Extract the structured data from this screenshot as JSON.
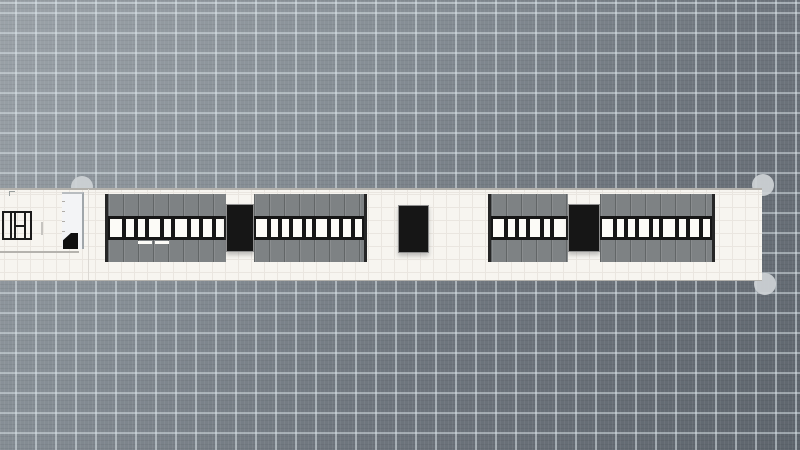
{
  "app": {
    "type": "floor-plan-editor",
    "view": "2d-top-plan",
    "visible_text": ""
  },
  "canvas": {
    "width": 800,
    "height": 450,
    "grid_major_size": 20,
    "grid_minor_size": 4
  },
  "colors": {
    "bg_light": "#9ca3a9",
    "bg_mid1": "#868e95",
    "bg_mid2": "#6f767e",
    "bg_dark": "#5e656d",
    "grid_major": "rgba(222,231,236,0.5)",
    "strip_fill": "#f7f5f0",
    "strip_grid": "#eae6e0",
    "strip_edge": "#b2b0ab",
    "shelf_gray": "#7e8284",
    "shelf_edge": "#262626",
    "window_black": "#161616",
    "cell_white": "#fcfbf7",
    "unit_black": "#161616",
    "unit_border": "#8f8f8f",
    "handle": "#ced3d6",
    "fixture_line": "#1b1b1b",
    "light_line": "#b5b3ae"
  },
  "floor_strip": {
    "x": 0,
    "y": 188,
    "width": 762,
    "height": 93,
    "grid_size": 13
  },
  "selection_handles": [
    {
      "id": "top-left",
      "cx": 82,
      "cy": 187,
      "r": 11
    },
    {
      "id": "top-right",
      "cx": 763,
      "cy": 185,
      "r": 11
    },
    {
      "id": "bottom-right",
      "cx": 765,
      "cy": 284,
      "r": 11
    }
  ],
  "shelf_runs": [
    {
      "id": "run-left",
      "x": 105,
      "y": 194,
      "height": 68,
      "segments": [
        {
          "kind": "bay",
          "width": 118,
          "cells": 9
        },
        {
          "kind": "end-cap",
          "width": 28
        },
        {
          "kind": "bay",
          "width": 110,
          "cells": 9
        }
      ]
    },
    {
      "id": "run-right",
      "x": 488,
      "y": 194,
      "height": 68,
      "segments": [
        {
          "kind": "bay",
          "width": 77,
          "cells": 6
        },
        {
          "kind": "end-cap",
          "width": 32
        },
        {
          "kind": "bay",
          "width": 112,
          "cells": 9
        }
      ]
    }
  ],
  "black_units": [
    {
      "id": "freestanding-end-unit",
      "x": 398,
      "y": 205,
      "width": 31,
      "height": 48
    }
  ],
  "cell_pattern": [
    1.5,
    1,
    1,
    1.3,
    0.9,
    1.6,
    1,
    1.2,
    1,
    1.1
  ],
  "price_tabs": [
    {
      "x": 138,
      "y": 241,
      "width": 14,
      "height": 3
    },
    {
      "x": 155,
      "y": 241,
      "width": 14,
      "height": 3
    }
  ],
  "left_fixtures": {
    "plan_symbol": {
      "x": 2,
      "y": 211,
      "width": 30,
      "height": 29
    },
    "corner_tick": {
      "x": 9,
      "y": 191,
      "width": 5,
      "height": 4
    },
    "door_tick": {
      "x": 41,
      "y": 222,
      "width": 2,
      "height": 13
    },
    "cabinet": {
      "x": 62,
      "y": 192,
      "width": 22,
      "height": 57,
      "ticks": 4
    },
    "wedge": {
      "x": 63,
      "y": 233,
      "width": 15,
      "height": 16
    },
    "baseline": {
      "x": 0,
      "y": 251,
      "width": 79,
      "height": 2
    },
    "divider_line": {
      "x": 88,
      "y": 189,
      "width": 1,
      "height": 91
    }
  }
}
